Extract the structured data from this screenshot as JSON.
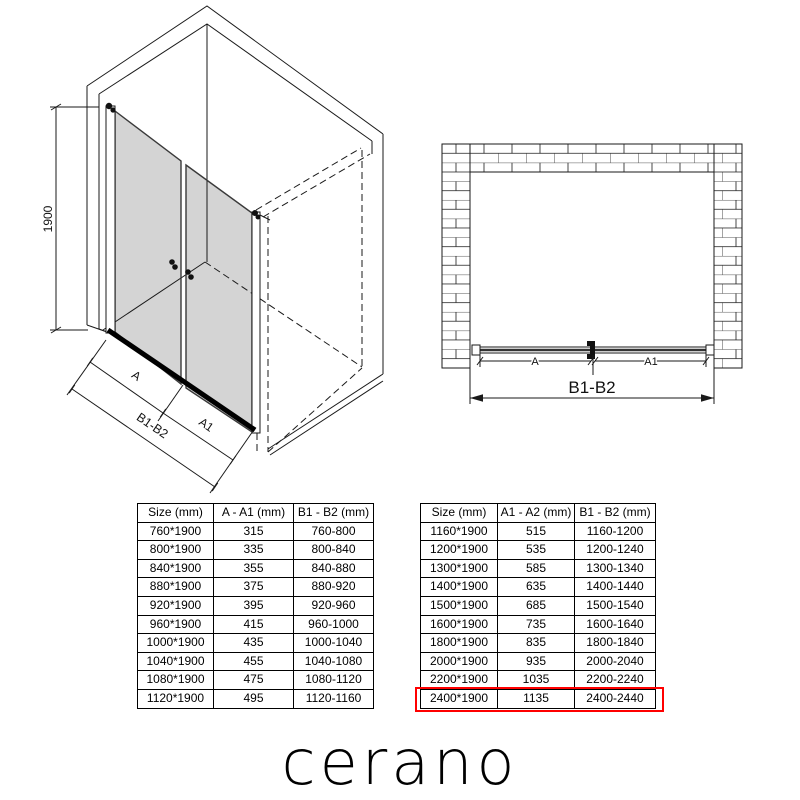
{
  "drawings": {
    "isometric": {
      "height_label": "1900",
      "dim_a": "A",
      "dim_a1": "A1",
      "dim_b": "B1-B2"
    },
    "front": {
      "dim_a": "A",
      "dim_a1": "A1",
      "dim_b": "B1-B2"
    }
  },
  "tables": {
    "left": {
      "headers": [
        "Size (mm)",
        "A - A1 (mm)",
        "B1 - B2 (mm)"
      ],
      "rows": [
        [
          "760*1900",
          "315",
          "760-800"
        ],
        [
          "800*1900",
          "335",
          "800-840"
        ],
        [
          "840*1900",
          "355",
          "840-880"
        ],
        [
          "880*1900",
          "375",
          "880-920"
        ],
        [
          "920*1900",
          "395",
          "920-960"
        ],
        [
          "960*1900",
          "415",
          "960-1000"
        ],
        [
          "1000*1900",
          "435",
          "1000-1040"
        ],
        [
          "1040*1900",
          "455",
          "1040-1080"
        ],
        [
          "1080*1900",
          "475",
          "1080-1120"
        ],
        [
          "1120*1900",
          "495",
          "1120-1160"
        ]
      ]
    },
    "right": {
      "headers": [
        "Size (mm)",
        "A1 - A2 (mm)",
        "B1 - B2 (mm)"
      ],
      "rows": [
        [
          "1160*1900",
          "515",
          "1160-1200"
        ],
        [
          "1200*1900",
          "535",
          "1200-1240"
        ],
        [
          "1300*1900",
          "585",
          "1300-1340"
        ],
        [
          "1400*1900",
          "635",
          "1400-1440"
        ],
        [
          "1500*1900",
          "685",
          "1500-1540"
        ],
        [
          "1600*1900",
          "735",
          "1600-1640"
        ],
        [
          "1800*1900",
          "835",
          "1800-1840"
        ],
        [
          "2000*1900",
          "935",
          "2000-2040"
        ],
        [
          "2200*1900",
          "1035",
          "2200-2240"
        ],
        [
          "2400*1900",
          "1135",
          "2400-2440"
        ]
      ],
      "highlighted_row_index": 9,
      "highlight_color": "#ff0000"
    }
  },
  "logo_text": "cerano"
}
